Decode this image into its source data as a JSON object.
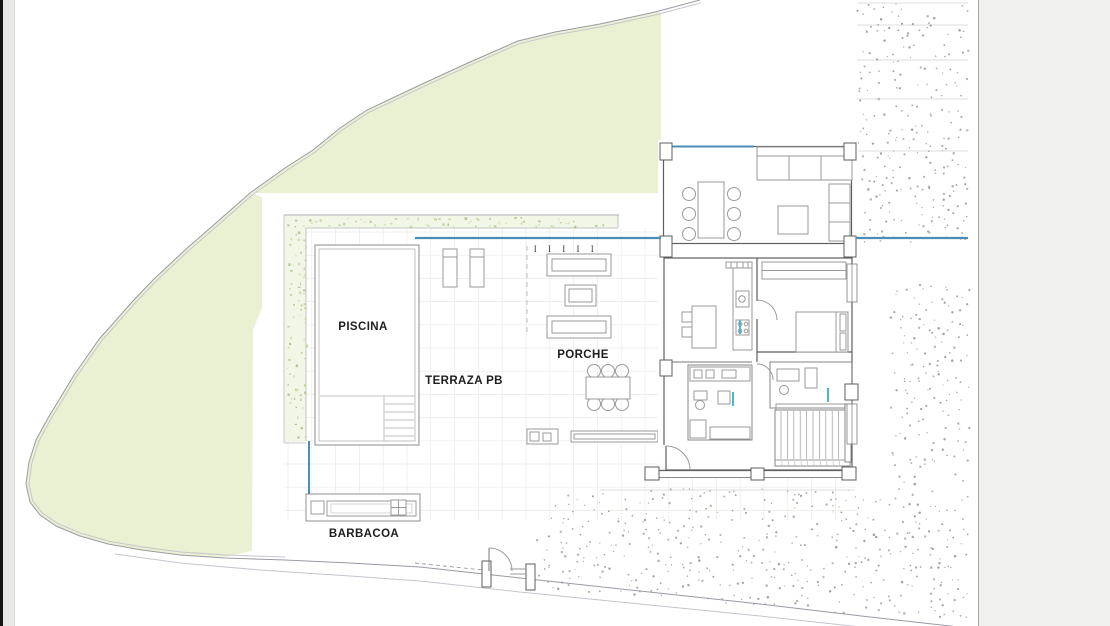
{
  "labels": {
    "piscina": "PISCINA",
    "terraza": "TERRAZA PB",
    "porche": "PORCHE",
    "barbacoa": "BARBACOA",
    "pergola_posts": "I I I I I"
  },
  "colors": {
    "lawn": "#eaf1d3",
    "hedge": "#f2f6e7",
    "hedge_speckle": "#b7d295",
    "boundary": "#9b99a4",
    "water_blue": "#4a8db5",
    "accent_cyan": "#49b8c8",
    "wall_dark": "#5e5e5e",
    "furniture_gray": "#9a9a9a",
    "tile_grid": "#eaeae5",
    "gravel_dot": "#b5b5b0",
    "paper": "#ffffff",
    "margin": "#f0f0ee",
    "film_edge": "#161616",
    "film_strip": "#e9e9e8"
  }
}
